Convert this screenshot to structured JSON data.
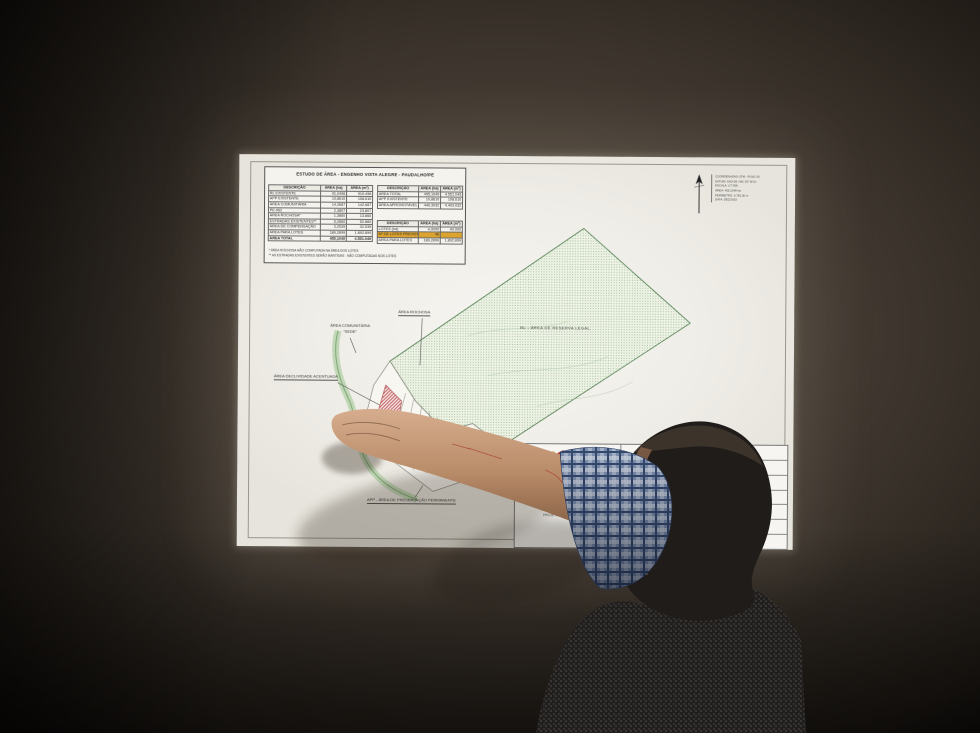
{
  "panel": {
    "title": "ESTUDO DE ÁREA - ENGENHO VISTA ALEGRE - PAUDALHO/PE",
    "headers": [
      "DESCRIÇÃO",
      "ÁREA (ha)",
      "ÁREA (m²)"
    ],
    "left_rows": [
      {
        "label": "RL EXISTENTE",
        "ha": "91,0496",
        "m2": "910.496"
      },
      {
        "label": "APP EXISTENTE",
        "ha": "10,8610",
        "m2": "108.610"
      },
      {
        "label": "ÁREA COMUNITÁRIA",
        "ha": "14,2687",
        "m2": "142.687"
      },
      {
        "label": "PE-062",
        "ha": "2,3807",
        "m2": "23.807"
      },
      {
        "label": "ÁREA ROCHOSA*",
        "ha": "1,3860",
        "m2": "13.860"
      },
      {
        "label": "ESTRADAS EXISTENTES**",
        "ha": "5,2860",
        "m2": "52.860"
      },
      {
        "label": "ÁREA DE COMPENSAÇÃO",
        "ha": "3,2539",
        "m2": "32.539"
      },
      {
        "label": "ÁREA PARA LOTES",
        "ha": "189,2899",
        "m2": "1.892.899"
      },
      {
        "label": "ÁREA TOTAL",
        "ha": "455,1049",
        "m2": "4.551.049",
        "total": true
      }
    ],
    "right1_rows": [
      {
        "label": "ÁREA TOTAL",
        "ha": "455,1049",
        "m2": "4.551.049"
      },
      {
        "label": "APP EXISTENTE",
        "ha": "10,8610",
        "m2": "108.610"
      },
      {
        "label": "ÁREA APROVEITÁVEL",
        "ha": "440,3032",
        "m2": "4.403.032"
      }
    ],
    "right2_rows": [
      {
        "label": "LOTES (ha)",
        "ha": "4,0000",
        "m2": "40.000"
      },
      {
        "label": "Nº DE LOTES PREVISTOS",
        "ha": "46",
        "m2": "",
        "hl": true
      },
      {
        "label": "ÁREA PARA LOTES",
        "ha": "189,2899",
        "m2": "1.892.899"
      }
    ],
    "footnotes": [
      "* ÁREA ROCHOSA NÃO COMPUTADA NA ÁREA DOS LOTES",
      "** AS ESTRADAS EXISTENTES SERÃO MANTIDAS - NÃO COMPUTADAS NOS LOTES"
    ]
  },
  "north": {
    "lines": [
      {
        "t": "COORDENADAS UTM - FUSO 25"
      },
      {
        "t": "DATUM: SAD-69 / MC 33° W.Gr."
      },
      {
        "t": "ESCALA: 1/7.500"
      },
      {
        "t": "ÁREA: 455,1049 ha"
      },
      {
        "t": "PERÍMETRO: 9.781,00 m"
      },
      {
        "t": "DATA: DEZ/2010"
      }
    ]
  },
  "map": {
    "labels": {
      "rochosa": "ÁREA ROCHOSA",
      "comunitaria": "ÁREA COMUNITÁRIA",
      "sede": "\"SEDE\"",
      "declividade": "ÁREA DECLIVIDADE ACENTUADA",
      "rl": "RL - ÁREA DE RESERVA LEGAL",
      "app": "APP - ÁREA DE PRESERVAÇÃO PERMANENTE"
    }
  },
  "logo": {
    "name": "Iterpe",
    "letters": [
      "I",
      "t",
      "e",
      "r",
      "p",
      "e"
    ],
    "subtitle": "INSTITUTO DE TERRAS E REFORMA AGRÁRIA DO ESTADO DE PERNAMBUCO",
    "colors": [
      "#2e9e3a",
      "#2b5fb0",
      "#cc2f2f",
      "#7a3fa0",
      "#2b5fb0",
      "#1f8f8f"
    ]
  },
  "titleblock": {
    "note": "PROJETO DE PARCELAMENTO",
    "rows": [
      {
        "t": "GOVERNO DO ESTADO DE PERNAMBUCO"
      },
      {
        "t": "ITERPE - INSTITUTO DE TERRAS"
      },
      {
        "t": "ENGENHO VISTA ALEGRE"
      },
      {
        "t": "MUNICÍPIO: PAUDALHO - PE"
      },
      {
        "t": "ESCALA: 1/7.500"
      },
      {
        "t": "ÁREA: 455,1049 ha"
      },
      {
        "t": "DATA: DEZ/2010"
      }
    ]
  },
  "colors": {
    "sheet": "#f0efe9",
    "wall": "#473e35",
    "rl_green_dots": "#76a072",
    "hatch_red": "#c25a5a",
    "highlight_orange": "#dda32f",
    "app_ribbon_green": "#b9d4ae"
  }
}
